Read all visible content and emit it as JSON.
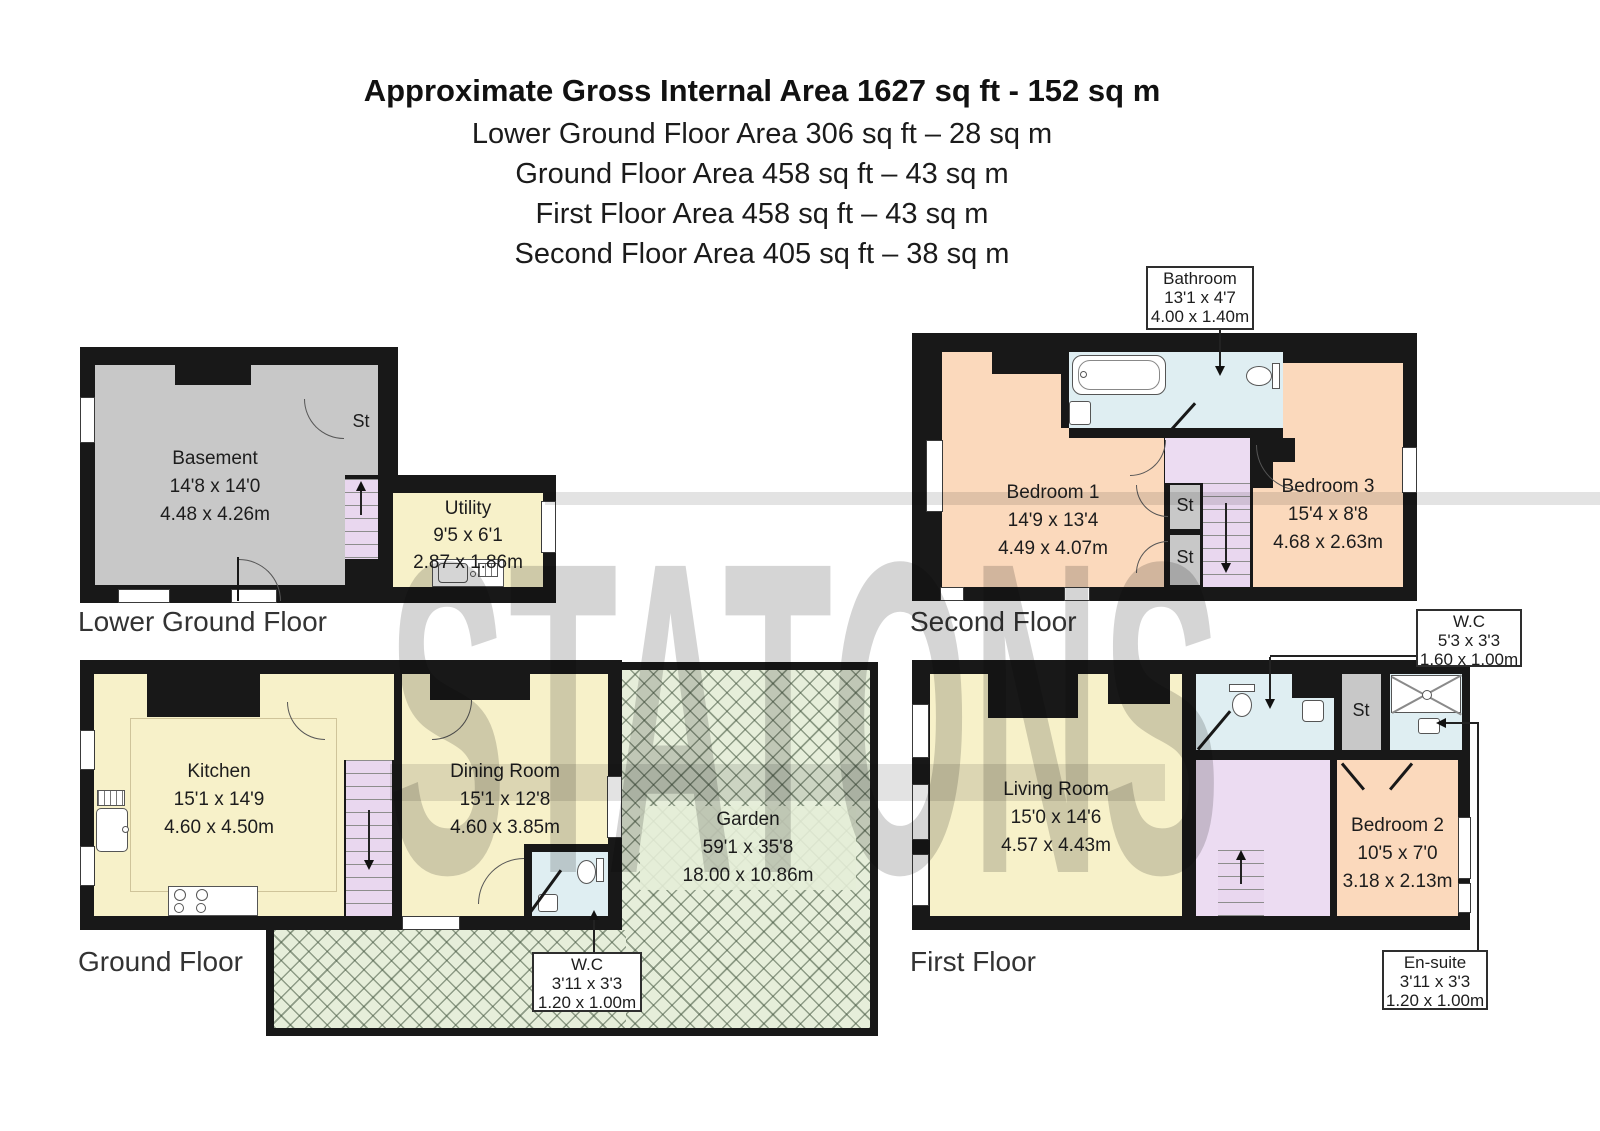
{
  "header": {
    "title": "Approximate Gross Internal Area 1627 sq ft - 152 sq m",
    "lines": [
      "Lower Ground Floor Area 306 sq ft – 28 sq m",
      "Ground Floor Area 458 sq ft – 43 sq m",
      "First Floor Area 458 sq ft – 43 sq m",
      "Second Floor Area 405 sq ft – 38 sq m"
    ]
  },
  "watermark": {
    "text": "STATONS"
  },
  "floors": {
    "lower_ground": {
      "label": "Lower Ground Floor",
      "basement": {
        "name": "Basement",
        "imperial": "14'8 x 14'0",
        "metric": "4.48 x 4.26m"
      },
      "utility": {
        "name": "Utility",
        "imperial": "9'5 x 6'1",
        "metric": "2.87 x 1.86m"
      },
      "storage": "St"
    },
    "ground": {
      "label": "Ground Floor",
      "kitchen": {
        "name": "Kitchen",
        "imperial": "15'1 x 14'9",
        "metric": "4.60 x 4.50m"
      },
      "dining": {
        "name": "Dining Room",
        "imperial": "15'1 x 12'8",
        "metric": "4.60 x 3.85m"
      },
      "garden": {
        "name": "Garden",
        "imperial": "59'1 x 35'8",
        "metric": "18.00 x 10.86m"
      },
      "wc": {
        "name": "W.C",
        "imperial": "3'11 x 3'3",
        "metric": "1.20 x 1.00m"
      }
    },
    "second": {
      "label": "Second Floor",
      "bathroom": {
        "name": "Bathroom",
        "imperial": "13'1 x 4'7",
        "metric": "4.00 x 1.40m"
      },
      "bedroom1": {
        "name": "Bedroom 1",
        "imperial": "14'9 x 13'4",
        "metric": "4.49 x 4.07m"
      },
      "bedroom3": {
        "name": "Bedroom 3",
        "imperial": "15'4 x 8'8",
        "metric": "4.68 x 2.63m"
      },
      "storage1": "St",
      "storage2": "St"
    },
    "first": {
      "label": "First Floor",
      "wc": {
        "name": "W.C",
        "imperial": "5'3 x 3'3",
        "metric": "1.60 x 1.00m"
      },
      "living": {
        "name": "Living Room",
        "imperial": "15'0 x 14'6",
        "metric": "4.57 x 4.43m"
      },
      "bedroom2": {
        "name": "Bedroom 2",
        "imperial": "10'5 x 7'0",
        "metric": "3.18 x 2.13m"
      },
      "ensuite": {
        "name": "En-suite",
        "imperial": "3'11 x 3'3",
        "metric": "1.20 x 1.00m"
      },
      "storage": "St"
    }
  },
  "colors": {
    "wall": "#181818",
    "room_yellow": "#f7f1c9",
    "room_peach": "#fbd9bc",
    "stairs_pink": "#ecdcf2",
    "wet_blue": "#dfeef2",
    "storage_grey": "#c8c8c8",
    "garden_green": "#e6eeda"
  }
}
